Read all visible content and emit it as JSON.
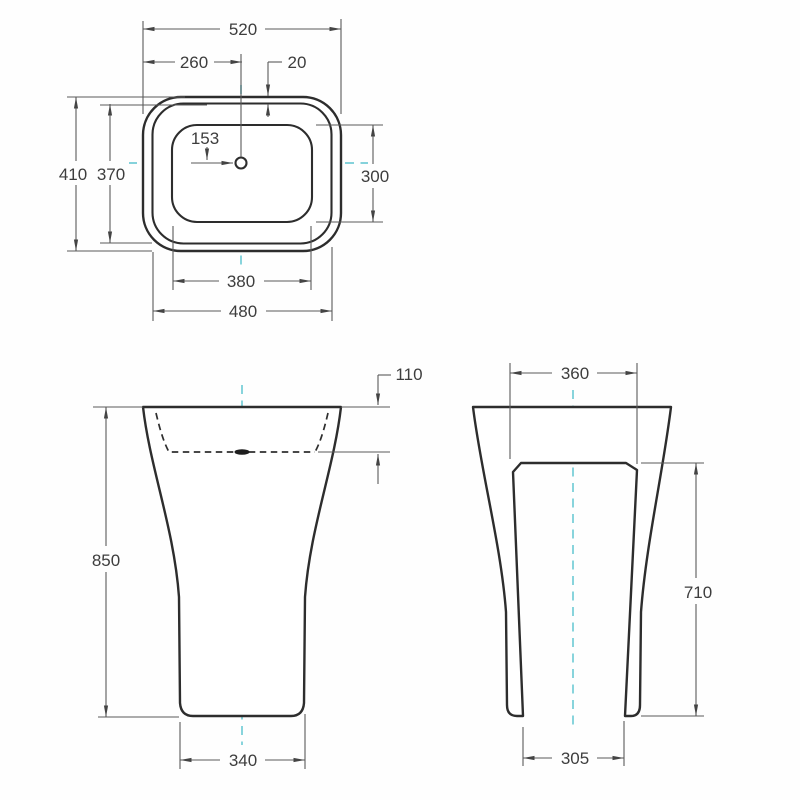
{
  "drawing": {
    "type": "pedestal-basin-technical-drawing",
    "colors": {
      "outline": "#2d2d2d",
      "dimension_lines": "#5a5a5a",
      "centerline_accent": "#74ccd6"
    },
    "top_view": {
      "overall_width": "520",
      "center_offset": "260",
      "rim_gap": "20",
      "tap_hole_offset": "153",
      "overall_depth": "410",
      "inner_rim_depth": "370",
      "bowl_depth": "300",
      "bowl_width": "380",
      "inner_rim_width": "480"
    },
    "front_view": {
      "bowl_inner_depth": "110",
      "overall_height": "850",
      "base_width": "340"
    },
    "side_view": {
      "top_width": "360",
      "recess_height": "710",
      "base_depth": "305"
    }
  }
}
